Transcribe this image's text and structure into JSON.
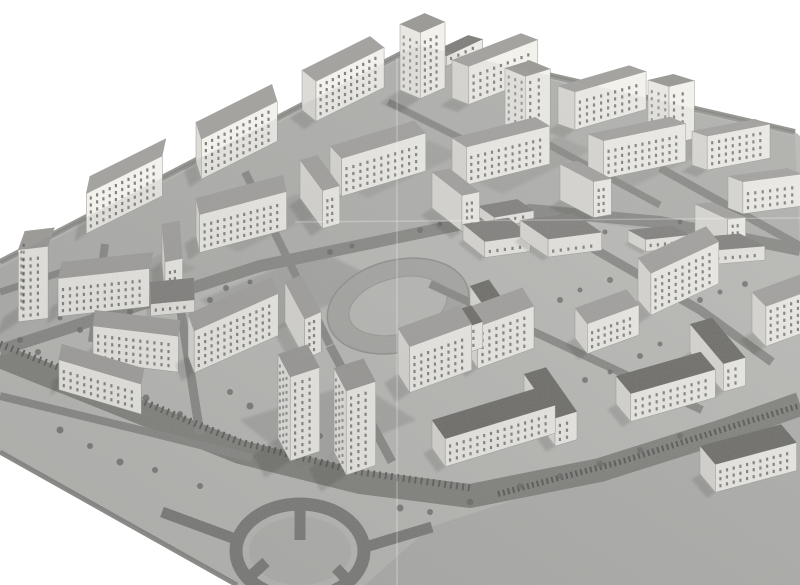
{
  "meta": {
    "description": "Black-and-white aerial photograph of an architectural scale model (maquette) of a modernist housing estate: rows of white slab apartment blocks and point towers around courtyards, low school buildings, a running-track sports field, a curved boulevard with a railway line, and a road roundabout at the lower left. White paper background shows at the top-left and bottom-left corners; a large empty grey field fills the bottom-right.",
    "width": 800,
    "height": 585
  },
  "palette": {
    "paper": "#ffffff",
    "ground": "#bdbdba",
    "ground_upper": "#b3b3b0",
    "field": "#b2b2af",
    "courtyard": "#a2a29f",
    "road": "#8b8b88",
    "road_dark": "#7d7d7a",
    "rail": "#5f5f5c",
    "wall_lit": "#f2f1ec",
    "wall_shade": "#dcdbd6",
    "wall_low": "#eceae5",
    "roof_flat": "#a4a3a0",
    "roof_tower": "#9c9b98",
    "roof_low": "#83827f",
    "roof_block": "#6f6e6a",
    "window": "#3c3c3c",
    "tree": "#6c6c69",
    "shadow": "#2a2a28"
  },
  "scene": {
    "vanishing_points": {
      "a": [
        -120,
        320
      ],
      "b": [
        140,
        -20
      ]
    },
    "plate": [
      [
        0,
        262
      ],
      [
        418,
        45
      ],
      [
        795,
        132
      ],
      [
        800,
        136
      ],
      [
        800,
        585
      ],
      [
        237,
        585
      ],
      [
        0,
        452
      ]
    ],
    "upper_ground": [
      [
        0,
        268
      ],
      [
        418,
        50
      ],
      [
        795,
        136
      ],
      [
        800,
        255
      ],
      [
        530,
        212
      ],
      [
        255,
        270
      ],
      [
        0,
        352
      ]
    ],
    "field": [
      [
        430,
        527
      ],
      [
        800,
        408
      ],
      [
        800,
        585
      ],
      [
        365,
        585
      ]
    ],
    "edge_line": [
      [
        0,
        262
      ],
      [
        418,
        45
      ],
      [
        795,
        132
      ]
    ],
    "lower_edge_line": [
      [
        0,
        452
      ],
      [
        237,
        585
      ]
    ],
    "courtyards": [
      [
        [
          70,
          298
        ],
        [
          162,
          254
        ],
        [
          196,
          268
        ],
        [
          104,
          314
        ]
      ],
      [
        [
          205,
          236
        ],
        [
          296,
          194
        ],
        [
          330,
          208
        ],
        [
          238,
          252
        ]
      ],
      [
        [
          336,
          182
        ],
        [
          428,
          140
        ],
        [
          460,
          154
        ],
        [
          368,
          198
        ]
      ],
      [
        [
          470,
          178
        ],
        [
          558,
          136
        ],
        [
          592,
          150
        ],
        [
          502,
          194
        ]
      ],
      [
        [
          600,
          172
        ],
        [
          688,
          132
        ],
        [
          720,
          146
        ],
        [
          630,
          188
        ]
      ],
      [
        [
          200,
          300
        ],
        [
          320,
          250
        ],
        [
          378,
          280
        ],
        [
          258,
          340
        ]
      ],
      [
        [
          240,
          420
        ],
        [
          356,
          382
        ],
        [
          416,
          420
        ],
        [
          300,
          468
        ]
      ]
    ],
    "sports_oval": {
      "cx": 398,
      "cy": 306,
      "rx": 72,
      "ry": 46,
      "rot": -14,
      "inner_rx": 50,
      "inner_ry": 28
    },
    "roundabout": {
      "cx": 300,
      "cy": 551,
      "rx": 64,
      "ry": 47,
      "ring": 13,
      "spokes": [
        [
          [
            300,
            506
          ],
          [
            300,
            540
          ]
        ],
        [
          [
            244,
            582
          ],
          [
            266,
            562
          ]
        ],
        [
          [
            352,
            585
          ],
          [
            336,
            568
          ]
        ],
        [
          [
            362,
            548
          ],
          [
            432,
            527
          ]
        ],
        [
          [
            238,
            540
          ],
          [
            162,
            512
          ]
        ]
      ]
    },
    "boulevard": {
      "pts": [
        [
          0,
          356
        ],
        [
          120,
          404
        ],
        [
          240,
          452
        ],
        [
          360,
          482
        ],
        [
          470,
          496
        ],
        [
          600,
          470
        ],
        [
          720,
          432
        ],
        [
          800,
          404
        ]
      ],
      "w": 24
    },
    "railway": {
      "pts": [
        [
          0,
          344
        ],
        [
          120,
          392
        ],
        [
          240,
          442
        ],
        [
          360,
          472
        ],
        [
          470,
          488
        ]
      ],
      "w": 7,
      "dash": "2 4"
    },
    "parked_cars": {
      "pts": [
        [
          498,
          494
        ],
        [
          620,
          462
        ],
        [
          740,
          424
        ],
        [
          798,
          406
        ]
      ],
      "w": 6,
      "dash": "2 3"
    },
    "roads": [
      {
        "pts": [
          [
            0,
            350
          ],
          [
            260,
            266
          ],
          [
            530,
            210
          ],
          [
            660,
            222
          ],
          [
            800,
            250
          ]
        ],
        "w": 12
      },
      {
        "pts": [
          [
            105,
            244
          ],
          [
            92,
            342
          ]
        ],
        "w": 8
      },
      {
        "pts": [
          [
            245,
            172
          ],
          [
            330,
            345
          ]
        ],
        "w": 8
      },
      {
        "pts": [
          [
            388,
            102
          ],
          [
            520,
            168
          ]
        ],
        "w": 7
      },
      {
        "pts": [
          [
            540,
            140
          ],
          [
            660,
            205
          ]
        ],
        "w": 7
      },
      {
        "pts": [
          [
            660,
            168
          ],
          [
            800,
            246
          ]
        ],
        "w": 8
      },
      {
        "pts": [
          [
            178,
            292
          ],
          [
            200,
            434
          ]
        ],
        "w": 9
      },
      {
        "pts": [
          [
            330,
            346
          ],
          [
            392,
            462
          ]
        ],
        "w": 9
      },
      {
        "pts": [
          [
            530,
            212
          ],
          [
            700,
            310
          ],
          [
            772,
            362
          ]
        ],
        "w": 9
      },
      {
        "pts": [
          [
            0,
            292
          ],
          [
            62,
            272
          ]
        ],
        "w": 7
      },
      {
        "pts": [
          [
            430,
            284
          ],
          [
            530,
            330
          ],
          [
            620,
            372
          ],
          [
            702,
            410
          ]
        ],
        "w": 8
      },
      {
        "pts": [
          [
            0,
            396
          ],
          [
            140,
            430
          ],
          [
            252,
            458
          ]
        ],
        "w": 8
      }
    ],
    "creases": [
      {
        "x1": 397,
        "y1": 58,
        "x2": 397,
        "y2": 585
      },
      {
        "x1": 295,
        "y1": 222,
        "x2": 800,
        "y2": 218
      }
    ],
    "trees": [
      [
        20,
        340,
        3
      ],
      [
        38,
        352,
        3
      ],
      [
        92,
        372,
        3.5
      ],
      [
        108,
        386,
        3
      ],
      [
        146,
        398,
        3.5
      ],
      [
        180,
        414,
        3
      ],
      [
        210,
        300,
        3
      ],
      [
        226,
        288,
        3
      ],
      [
        250,
        282,
        2.5
      ],
      [
        330,
        252,
        3
      ],
      [
        352,
        246,
        2.5
      ],
      [
        420,
        230,
        3
      ],
      [
        440,
        224,
        2.5
      ],
      [
        300,
        420,
        3.5
      ],
      [
        320,
        436,
        3
      ],
      [
        365,
        448,
        3.5
      ],
      [
        470,
        318,
        3
      ],
      [
        490,
        308,
        2.5
      ],
      [
        560,
        300,
        3
      ],
      [
        580,
        290,
        2.5
      ],
      [
        610,
        280,
        3
      ],
      [
        640,
        356,
        3
      ],
      [
        660,
        344,
        2.5
      ],
      [
        700,
        300,
        3
      ],
      [
        720,
        292,
        2.5
      ],
      [
        745,
        284,
        3
      ],
      [
        400,
        508,
        3.5
      ],
      [
        430,
        512,
        3
      ],
      [
        470,
        502,
        3.5
      ],
      [
        520,
        486,
        3
      ],
      [
        560,
        476,
        3
      ],
      [
        600,
        464,
        3.5
      ],
      [
        640,
        450,
        3
      ],
      [
        680,
        436,
        3
      ],
      [
        80,
        330,
        3
      ],
      [
        60,
        318,
        2.5
      ],
      [
        130,
        312,
        3
      ],
      [
        230,
        392,
        3
      ],
      [
        250,
        406,
        3.5
      ],
      [
        505,
        346,
        3
      ],
      [
        530,
        338,
        2.5
      ],
      [
        585,
        380,
        3
      ],
      [
        610,
        372,
        2.5
      ],
      [
        690,
        386,
        3
      ],
      [
        710,
        378,
        2.5
      ],
      [
        60,
        430,
        3.5
      ],
      [
        90,
        446,
        3
      ],
      [
        120,
        462,
        3.5
      ],
      [
        660,
        230,
        2.5
      ],
      [
        680,
        222,
        2.5
      ],
      [
        585,
        240,
        2.5
      ],
      [
        605,
        232,
        2.5
      ],
      [
        155,
        470,
        3
      ],
      [
        200,
        486,
        3
      ]
    ],
    "buildings": [
      [
        90,
        216,
        85,
        18,
        40,
        "slab"
      ],
      [
        196,
        162,
        85,
        18,
        40,
        "slab"
      ],
      [
        302,
        110,
        76,
        18,
        40,
        "slab"
      ],
      [
        400,
        90,
        27,
        22,
        66,
        "tower"
      ],
      [
        452,
        98,
        74,
        18,
        38,
        "slab"
      ],
      [
        558,
        124,
        74,
        18,
        38,
        "slab"
      ],
      [
        505,
        130,
        26,
        22,
        62,
        "tower"
      ],
      [
        648,
        138,
        26,
        22,
        58,
        "tower"
      ],
      [
        692,
        165,
        64,
        16,
        34,
        "slab"
      ],
      [
        728,
        208,
        60,
        16,
        32,
        "slab"
      ],
      [
        432,
        62,
        40,
        15,
        10,
        "low"
      ],
      [
        25,
        303,
        30,
        20,
        72,
        "tower"
      ],
      [
        62,
        300,
        92,
        17,
        38,
        "slab"
      ],
      [
        162,
        262,
        18,
        38,
        38,
        "slab"
      ],
      [
        196,
        236,
        90,
        17,
        38,
        "slab"
      ],
      [
        300,
        198,
        18,
        38,
        38,
        "slab"
      ],
      [
        330,
        184,
        88,
        17,
        38,
        "slab"
      ],
      [
        432,
        208,
        18,
        38,
        36,
        "slab"
      ],
      [
        452,
        176,
        86,
        17,
        38,
        "slab"
      ],
      [
        560,
        200,
        18,
        38,
        36,
        "slab"
      ],
      [
        588,
        172,
        84,
        17,
        38,
        "slab"
      ],
      [
        695,
        238,
        18,
        36,
        34,
        "slab"
      ],
      [
        150,
        294,
        44,
        22,
        12,
        "low"
      ],
      [
        478,
        216,
        40,
        20,
        10,
        "low"
      ],
      [
        628,
        242,
        44,
        20,
        12,
        "low"
      ],
      [
        95,
        346,
        86,
        16,
        36,
        "slab"
      ],
      [
        62,
        374,
        86,
        16,
        30,
        "slab"
      ],
      [
        188,
        356,
        92,
        18,
        42,
        "slab",
        -24,
        70
      ],
      [
        285,
        322,
        18,
        42,
        40,
        "slab",
        -24,
        62
      ],
      [
        463,
        240,
        46,
        28,
        16,
        "low"
      ],
      [
        520,
        238,
        54,
        34,
        18,
        "low"
      ],
      [
        688,
        252,
        52,
        28,
        14,
        "low"
      ],
      [
        745,
        200,
        40,
        24,
        14,
        "low"
      ],
      [
        638,
        300,
        75,
        20,
        42,
        "slab",
        -25,
        50
      ],
      [
        752,
        332,
        66,
        20,
        40,
        "slab",
        -20,
        46
      ],
      [
        278,
        438,
        31,
        26,
        84,
        "tower",
        -18,
        62
      ],
      [
        334,
        452,
        31,
        26,
        84,
        "tower",
        -18,
        62
      ],
      [
        398,
        374,
        66,
        22,
        46,
        "slab",
        -20,
        58
      ],
      [
        466,
        350,
        60,
        22,
        42,
        "slab",
        -20,
        58
      ],
      [
        405,
        354,
        70,
        20,
        26,
        "block",
        -19,
        55
      ],
      [
        470,
        312,
        20,
        44,
        26,
        "block",
        -19,
        55
      ],
      [
        575,
        338,
        55,
        20,
        30,
        "slab",
        -20,
        52
      ],
      [
        432,
        448,
        115,
        23,
        28,
        "block",
        -17,
        55
      ],
      [
        524,
        402,
        23,
        54,
        28,
        "block",
        -17,
        55
      ],
      [
        616,
        404,
        88,
        23,
        28,
        "block",
        -16,
        50
      ],
      [
        690,
        352,
        23,
        52,
        28,
        "block",
        -16,
        50
      ],
      [
        700,
        474,
        84,
        24,
        28,
        "block",
        -15,
        50
      ]
    ]
  }
}
